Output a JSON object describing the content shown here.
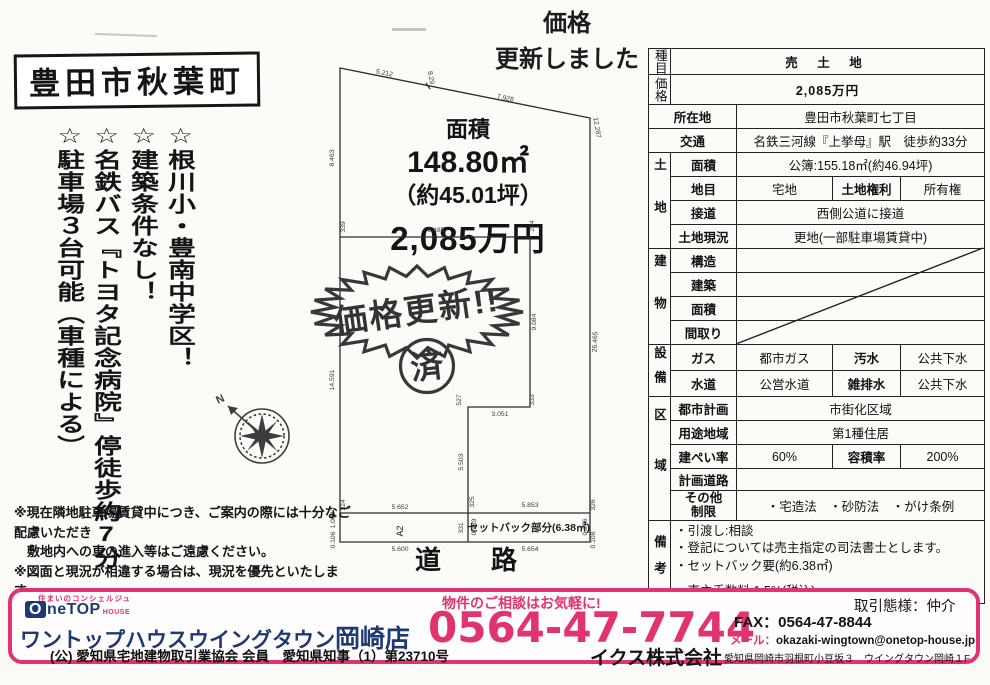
{
  "notice": {
    "line1": "価格",
    "line2": "更新しました"
  },
  "title": "豊田市秋葉町",
  "features": [
    "☆根川小・豊南中学区！",
    "☆建築条件なし！",
    "☆名鉄バス『トヨタ記念病院』停徒歩約7分",
    "☆駐車場３台可能（車種による）"
  ],
  "diagram": {
    "area_label": "面積",
    "area_m2": "148.80㎡",
    "area_tsubo": "（約45.01坪）",
    "price": "2,085万円",
    "stamp_text": "価格更新!!",
    "seal_text": "済",
    "strip_a2": "A2",
    "setback": "セットバック部分(6.38㎡)",
    "road": "道　路",
    "compass_n": "N",
    "dim_labels": [
      {
        "t": "5.212",
        "x": 84,
        "y": 25,
        "r": 11
      },
      {
        "t": "8.29",
        "x": 129,
        "y": 28,
        "r": 80
      },
      {
        "t": "7.928",
        "x": 205,
        "y": 50,
        "r": 11
      },
      {
        "t": "12.287",
        "x": 295,
        "y": 78,
        "r": 80
      },
      {
        "t": "8.463",
        "x": 34,
        "y": 108,
        "r": -90
      },
      {
        "t": "14.591",
        "x": 34,
        "y": 330,
        "r": -90
      },
      {
        "t": "26.465",
        "x": 297,
        "y": 292,
        "r": -88
      },
      {
        "t": "9.485",
        "x": 136,
        "y": 182,
        "r": 0
      },
      {
        "t": "339",
        "x": 45,
        "y": 177,
        "r": -90
      },
      {
        "t": "204",
        "x": 234,
        "y": 176,
        "r": -90
      },
      {
        "t": "9.084",
        "x": 236,
        "y": 272,
        "r": -90
      },
      {
        "t": "527",
        "x": 161,
        "y": 350,
        "r": -90
      },
      {
        "t": "333",
        "x": 234,
        "y": 350,
        "r": -90
      },
      {
        "t": "3.051",
        "x": 200,
        "y": 366,
        "r": 0
      },
      {
        "t": "5.503",
        "x": 163,
        "y": 412,
        "r": -90
      },
      {
        "t": "5.652",
        "x": 100,
        "y": 459,
        "r": 0
      },
      {
        "t": "5.853",
        "x": 230,
        "y": 457,
        "r": 0
      },
      {
        "t": "5.600",
        "x": 100,
        "y": 501,
        "r": 0
      },
      {
        "t": "5.654",
        "x": 230,
        "y": 501,
        "r": 0
      },
      {
        "t": "324",
        "x": 45,
        "y": 455,
        "r": -90
      },
      {
        "t": "325",
        "x": 174,
        "y": 452,
        "r": -90
      },
      {
        "t": "326",
        "x": 295,
        "y": 455,
        "r": -90
      },
      {
        "t": "331",
        "x": 163,
        "y": 478,
        "r": -90
      },
      {
        "t": "0.989",
        "x": 176,
        "y": 477,
        "r": -90
      },
      {
        "t": "0.976",
        "x": 287,
        "y": 477,
        "r": -90
      },
      {
        "t": "1.002",
        "x": 35,
        "y": 470,
        "r": -90
      },
      {
        "t": "0.106",
        "x": 35,
        "y": 490,
        "r": -90
      },
      {
        "t": "0.108",
        "x": 295,
        "y": 490,
        "r": -90
      }
    ]
  },
  "notes": [
    "※現在隣地駐車場賃貸中につき、ご案内の際には十分なご配慮いただき",
    "　敷地内への車の進入等はご遠慮ください。",
    "※図面と現況が相違する場合は、現況を優先といたします。"
  ],
  "table": {
    "type_label": "種目",
    "type_value": "売 土 地",
    "price_label": "価格",
    "price_value": "2,085万円",
    "location_label": "所在地",
    "location_value": "豊田市秋葉町七丁目",
    "access_label": "交通",
    "access_value": "名鉄三河線『上挙母』駅　徒歩約33分",
    "land": {
      "group": "土地",
      "area_label": "面積",
      "area_value": "公簿:155.18㎡(約46.94坪)",
      "category_label": "地目",
      "category_value": "宅地",
      "rights_label": "土地権利",
      "rights_value": "所有権",
      "road_label": "接道",
      "road_value": "西側公道に接道",
      "status_label": "土地現況",
      "status_value": "更地(一部駐車場賃貸中)"
    },
    "building": {
      "group": "建物",
      "rows": [
        "構造",
        "建築",
        "面積",
        "間取り"
      ]
    },
    "utilities": {
      "group": "設備",
      "gas_label": "ガス",
      "gas_value": "都市ガス",
      "sewage_label": "汚水",
      "sewage_value": "公共下水",
      "water_label": "水道",
      "water_value": "公営水道",
      "drain_label": "雑排水",
      "drain_value": "公共下水"
    },
    "zoning": {
      "group": "区域",
      "cityplan_label": "都市計画",
      "cityplan_value": "市街化区域",
      "use_label": "用途地域",
      "use_value": "第1種住居",
      "bcr_label": "建ぺい率",
      "bcr_value": "60%",
      "far_label": "容積率",
      "far_value": "200%",
      "planned_road_label": "計画道路",
      "planned_road_value": "",
      "other_label": "その他\n制限",
      "other_value": "・宅造法　・砂防法　・がけ条例"
    },
    "remarks": {
      "group": "備考",
      "items": [
        "・引渡し:相談",
        "・登記については売主指定の司法書士とします。",
        "・セットバック要(約6.38㎡)",
        "・売主手数料:1.5%(税込)"
      ]
    }
  },
  "footer": {
    "logo_tagline": "住まいのコンシェルジュ",
    "logo_o": "O",
    "logo_rest": "neTOP",
    "logo_house": "HOUSE",
    "shop_name": "ワントップハウスウイングタウン",
    "shop_branch": "岡崎店",
    "license": "(公) 愛知県宅地建物取引業協会 会員　愛知県知事（1）第23710号",
    "cta": "物件のご相談はお気軽に!",
    "phone": "0564-47-7744",
    "fax": "FAX：0564-47-8844",
    "mail_label": "メール：",
    "mail_value": "okazaki-wingtown@onetop-house.jp",
    "deal_type": "取引態様：仲介",
    "company": "イクス株式会社",
    "address": "愛知県岡崎市羽根町小豆坂３　ウイングタウン岡崎１F"
  }
}
